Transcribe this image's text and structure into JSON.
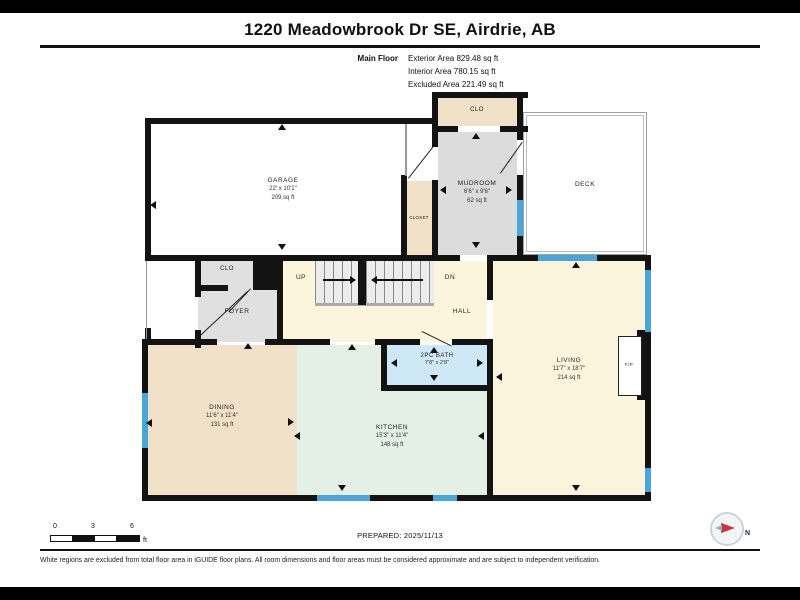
{
  "header": {
    "title": "1220 Meadowbrook Dr SE, Airdrie, AB",
    "floor_label": "Main Floor",
    "area_lines": [
      "Exterior Area 829.48 sq ft",
      "Interior Area 780.15 sq ft",
      "Excluded Area 221.49 sq ft"
    ]
  },
  "rooms": {
    "garage": {
      "name": "GARAGE",
      "dims": "22' x 10'1\"",
      "area": "209 sq ft"
    },
    "mudroom_clo": {
      "name": "CLO"
    },
    "mudroom": {
      "name": "MUDROOM",
      "dims": "6'6\" x 9'6\"",
      "area": "62 sq ft"
    },
    "closet": {
      "name": "CLOSET"
    },
    "deck": {
      "name": "DECK"
    },
    "foyer_clo": {
      "name": "CLO"
    },
    "foyer": {
      "name": "FOYER"
    },
    "stairs_up": {
      "name": "UP"
    },
    "stairs_dn": {
      "name": "DN"
    },
    "hall": {
      "name": "HALL"
    },
    "bath": {
      "name": "2PC BATH",
      "dims": "7'8\" x 2'8\""
    },
    "dining": {
      "name": "DINING",
      "dims": "11'6\" x 11'4\"",
      "area": "131 sq ft"
    },
    "kitchen": {
      "name": "KITCHEN",
      "dims": "15'3\" x 11'4\"",
      "area": "148 sq ft"
    },
    "living": {
      "name": "LIVING",
      "dims": "11'7\" x 18'7\"",
      "area": "214 sq ft"
    },
    "fireplace": {
      "name": "F/P"
    }
  },
  "footer": {
    "scale_ticks": [
      "0",
      "3",
      "6"
    ],
    "scale_unit": "ft",
    "prepared": "PREPARED: 2025/11/13",
    "compass_label": "N",
    "disclaimer": "White regions are excluded from total floor area in iGUIDE floor plans. All room dimensions and floor areas must be considered approximate and are subject to independent verification."
  },
  "colors": {
    "wall": "#131313",
    "window_blue": "#4ba5d9",
    "tan": "#f0e1c8",
    "cream": "#fcf5dd",
    "mint": "#e4efe5",
    "foyer_gray": "#e0e0e0",
    "mudroom_gray": "#dcdcdc",
    "bath_blue": "#cfe8f8",
    "compass_red": "#cc3333"
  }
}
